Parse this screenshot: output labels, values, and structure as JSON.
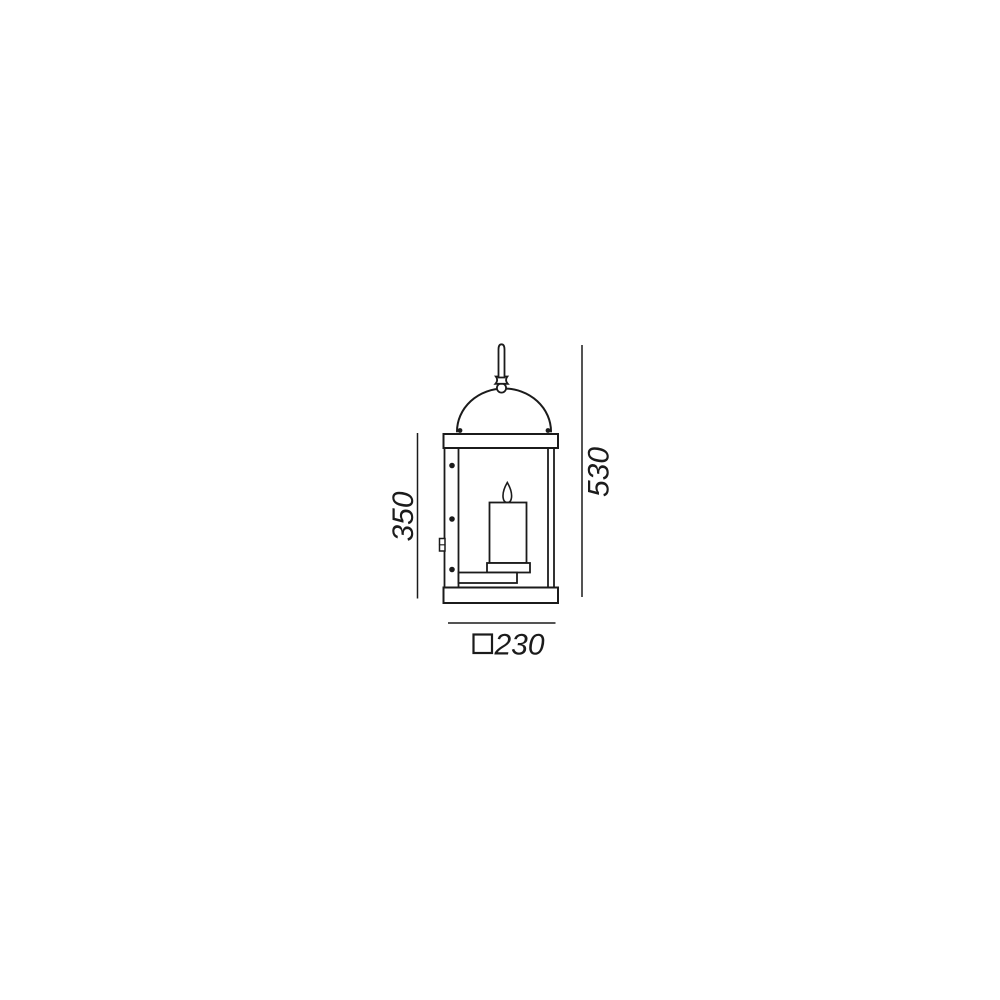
{
  "diagram": {
    "kind": "technical-dimension-drawing",
    "subject": "hanging candle lantern, side view",
    "background_color": "#ffffff",
    "line_color": "#1b1b1b",
    "dimensions": {
      "body_height": "350",
      "total_height": "530",
      "base_width": "230",
      "base_width_symbol": "square-section-symbol"
    }
  }
}
